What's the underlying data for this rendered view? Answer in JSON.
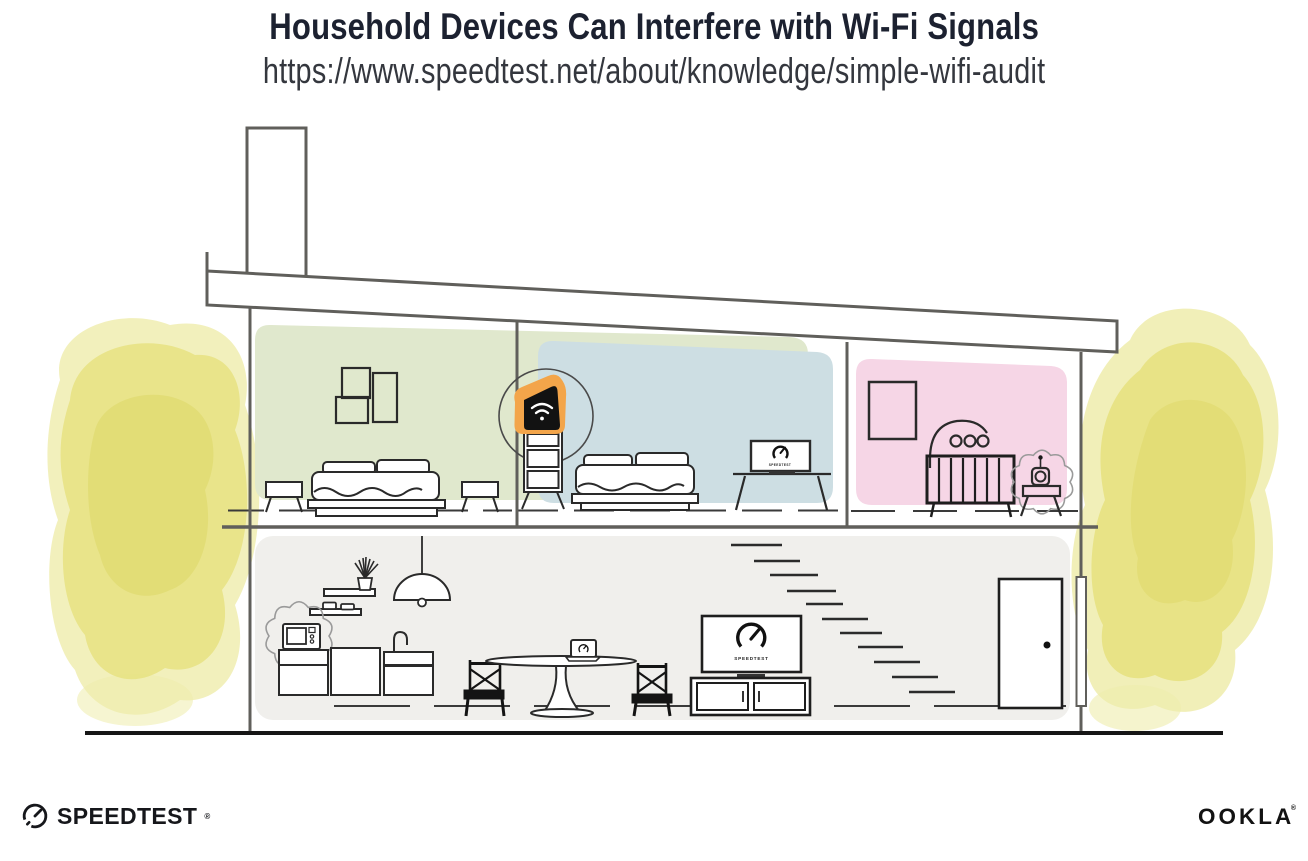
{
  "header": {
    "title": "Household Devices Can Interfere with Wi-Fi Signals",
    "subtitle_url": "https://www.speedtest.net/about/knowledge/simple-wifi-audit"
  },
  "branding": {
    "speedtest_logo_text": "SPEEDTEST",
    "speedtest_reg_mark": "®",
    "ookla_logo_text": "OOKLA",
    "ookla_reg_mark": "®"
  },
  "illustration": {
    "description": "Cross-section of a two-story house; a highlighted Wi-Fi router sits on a dresser between upstairs bedrooms while household devices (microwave oven, baby monitor) emit interference squiggles; screens around the house show the Speedtest gauge.",
    "rooms": [
      {
        "name": "Bedroom 1",
        "floor": "upper",
        "color": "#e0e8cd"
      },
      {
        "name": "Bedroom 2",
        "floor": "upper",
        "color": "#cdder-"
      },
      {
        "name": "Nursery",
        "floor": "upper",
        "color": "#f6d6e6"
      },
      {
        "name": "Living room and kitchen",
        "floor": "ground",
        "color": "#f0efec"
      }
    ],
    "room_colors": {
      "bedroom1": "#e0e8cd",
      "bedroom2": "#cddee3",
      "nursery": "#f6d6e6",
      "ground_floor": "#f0efec"
    },
    "devices": [
      {
        "name": "Wi-Fi router",
        "location": "dresser between bedrooms",
        "highlighted": true
      },
      {
        "name": "Desk monitor",
        "location": "Bedroom 2",
        "screen_label": "SPEEDTEST"
      },
      {
        "name": "Baby monitor",
        "location": "Nursery",
        "interference": true
      },
      {
        "name": "Microwave oven",
        "location": "Kitchen",
        "interference": true
      },
      {
        "name": "Laptop",
        "location": "Dining table"
      },
      {
        "name": "TV",
        "location": "Living room",
        "screen_label": "SPEEDTEST"
      }
    ],
    "screen_labels": {
      "tv": "SPEEDTEST",
      "desk_monitor": "SPEEDTEST"
    },
    "colors": {
      "router_orange": "#f3a54a",
      "watercolor_yellow": "#e6e17d",
      "watercolor_yellow_light": "#efecab",
      "watercolor_yellow_dark": "#ddd766",
      "structure_gray": "#605f5b",
      "ink": "#262626",
      "title_ink": "#1c2130"
    }
  }
}
